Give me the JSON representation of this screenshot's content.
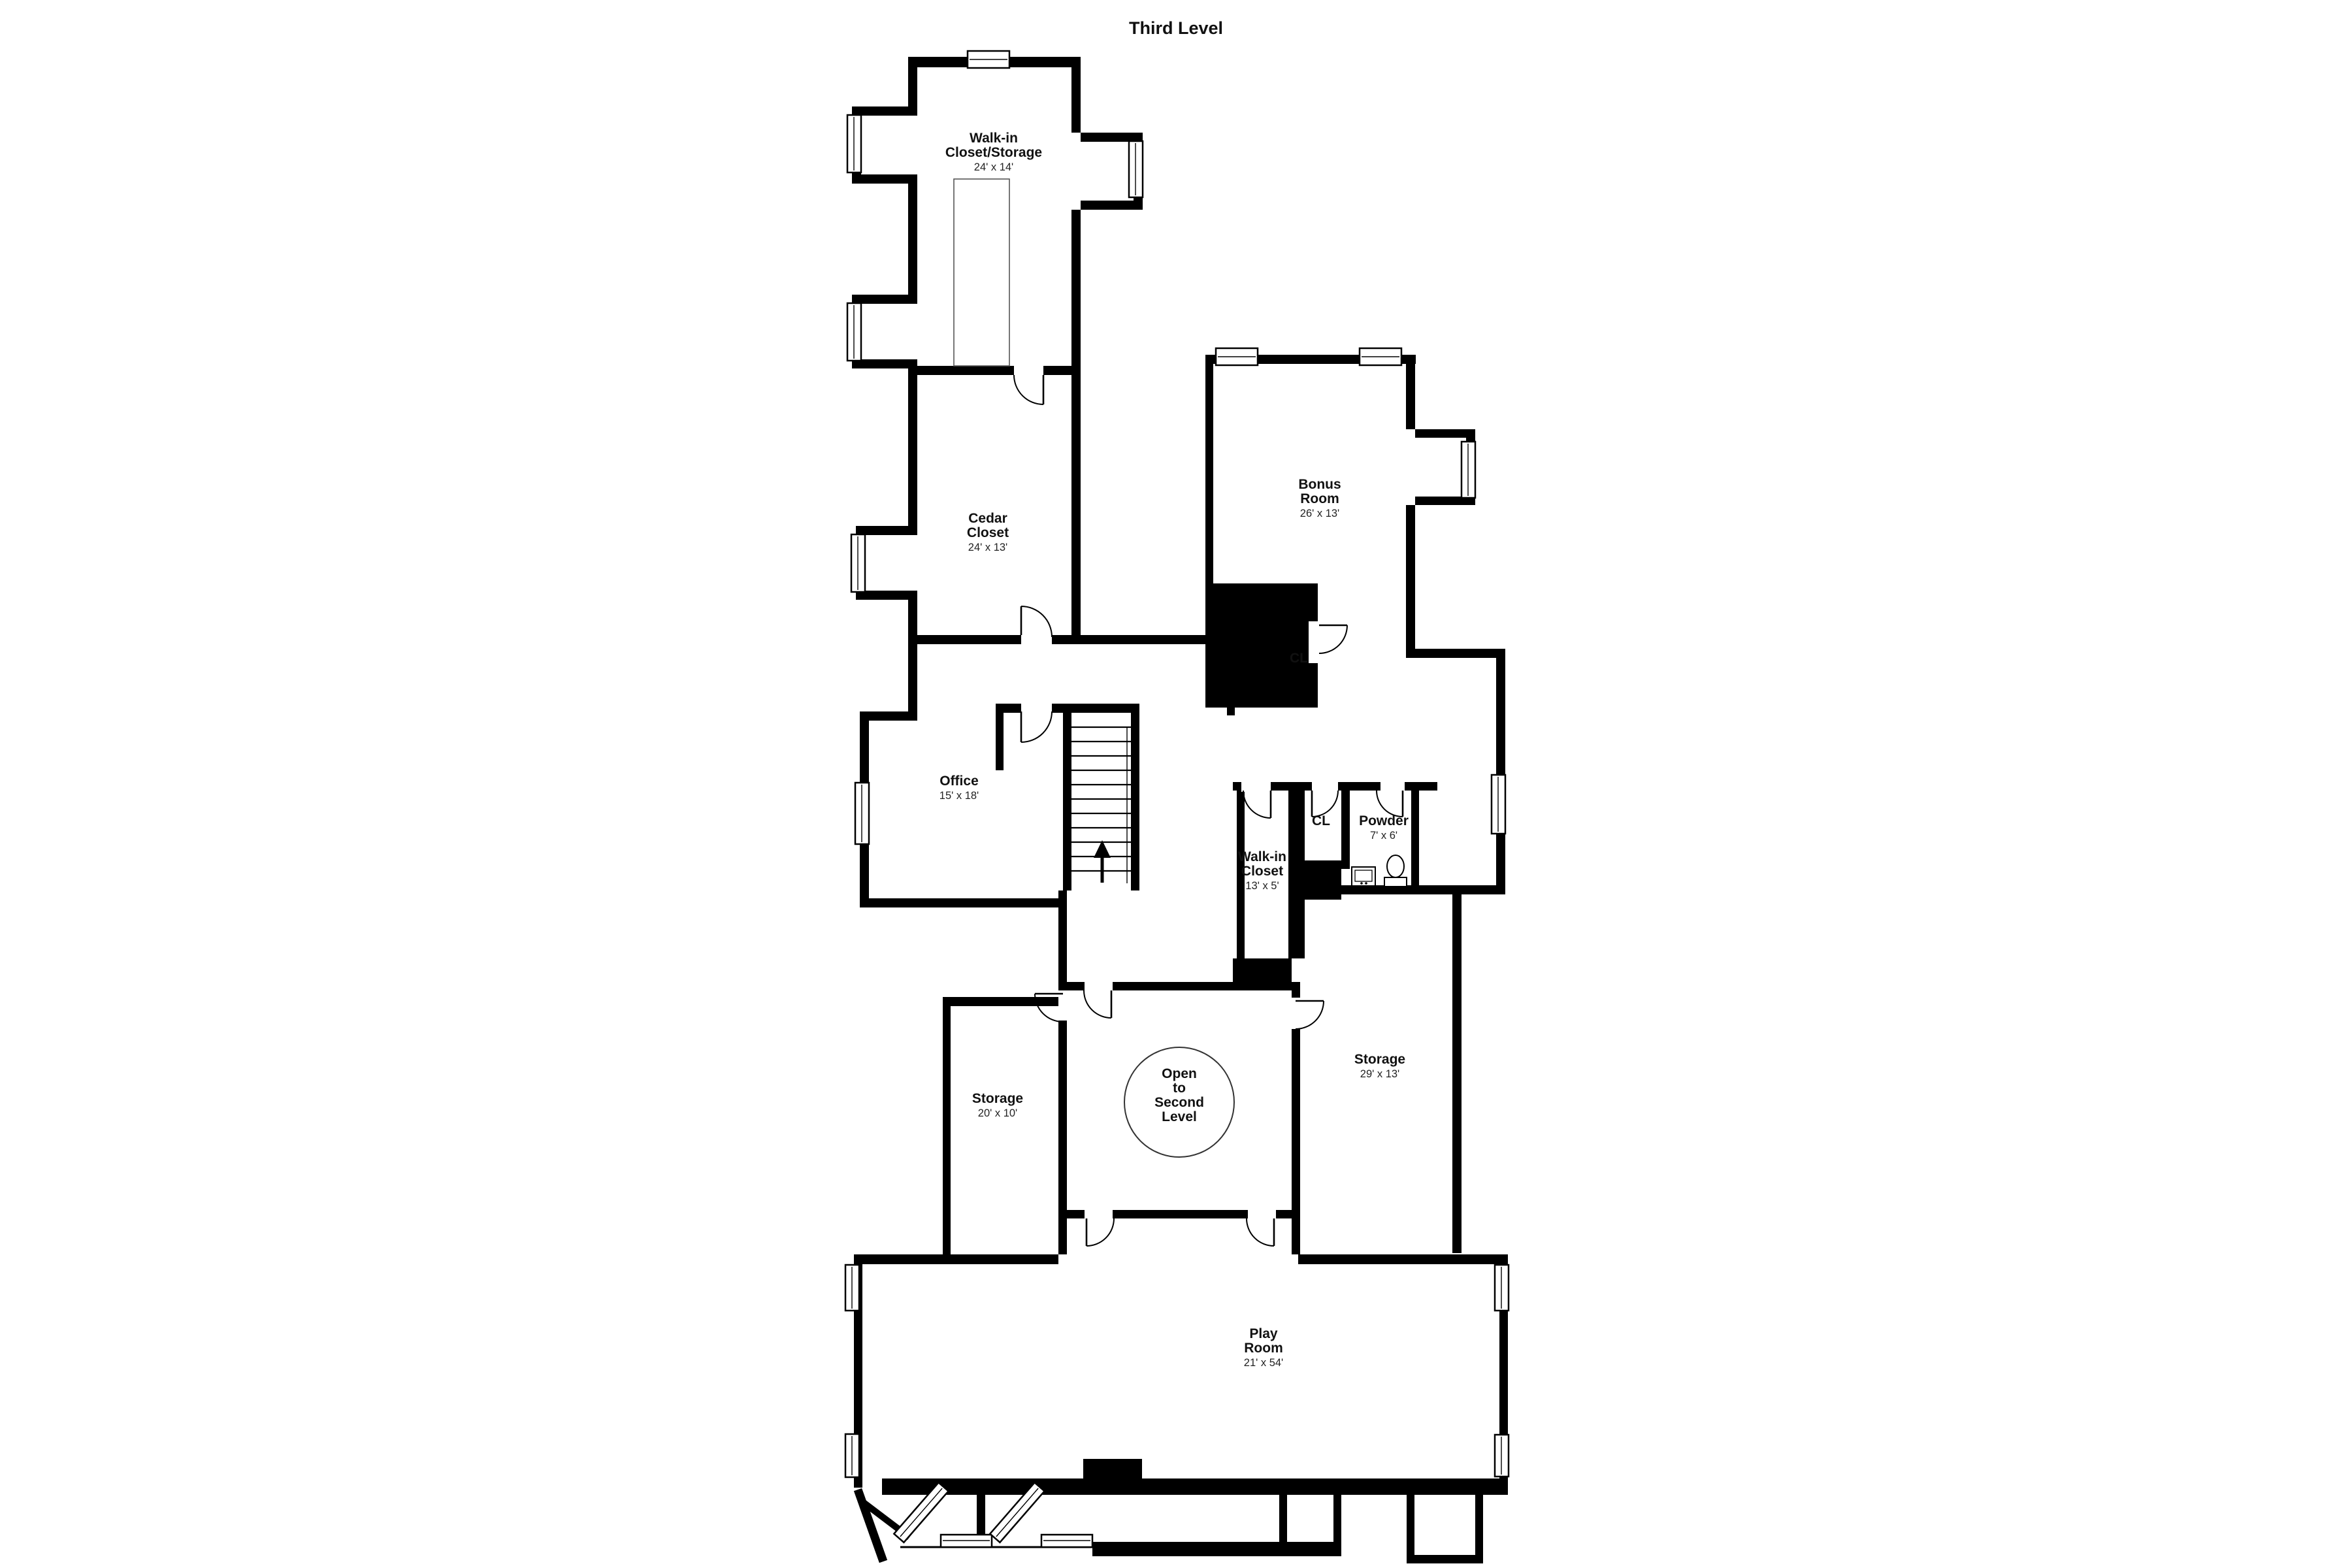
{
  "title": "Third Level",
  "rooms": [
    {
      "id": "walk-in-closet-storage",
      "lines": [
        "Walk-in",
        "Closet/Storage"
      ],
      "dims": "24' x 14'"
    },
    {
      "id": "cedar-closet",
      "lines": [
        "Cedar",
        "Closet"
      ],
      "dims": "24' x 13'"
    },
    {
      "id": "bonus-room",
      "lines": [
        "Bonus",
        "Room"
      ],
      "dims": "26' x 13'"
    },
    {
      "id": "closet-bonus",
      "lines": [
        "CL"
      ],
      "dims": ""
    },
    {
      "id": "office",
      "lines": [
        "Office"
      ],
      "dims": "15' x 18'"
    },
    {
      "id": "walk-in-closet",
      "lines": [
        "Walk-in",
        "Closet"
      ],
      "dims": "13' x 5'"
    },
    {
      "id": "closet-powder",
      "lines": [
        "CL"
      ],
      "dims": ""
    },
    {
      "id": "powder",
      "lines": [
        "Powder"
      ],
      "dims": "7' x 6'"
    },
    {
      "id": "storage-20",
      "lines": [
        "Storage"
      ],
      "dims": "20' x 10'"
    },
    {
      "id": "open-to-second-level",
      "lines": [
        "Open",
        "to",
        "Second",
        "Level"
      ],
      "dims": ""
    },
    {
      "id": "storage-29",
      "lines": [
        "Storage"
      ],
      "dims": "29' x 13'"
    },
    {
      "id": "play-room",
      "lines": [
        "Play",
        "Room"
      ],
      "dims": "21' x 54'"
    }
  ],
  "icons": {
    "stairs_direction": "up-arrow",
    "powder_fixtures": [
      "sink",
      "toilet"
    ]
  },
  "colors": {
    "wall": "#000000",
    "background": "#ffffff",
    "text": "#111111"
  }
}
